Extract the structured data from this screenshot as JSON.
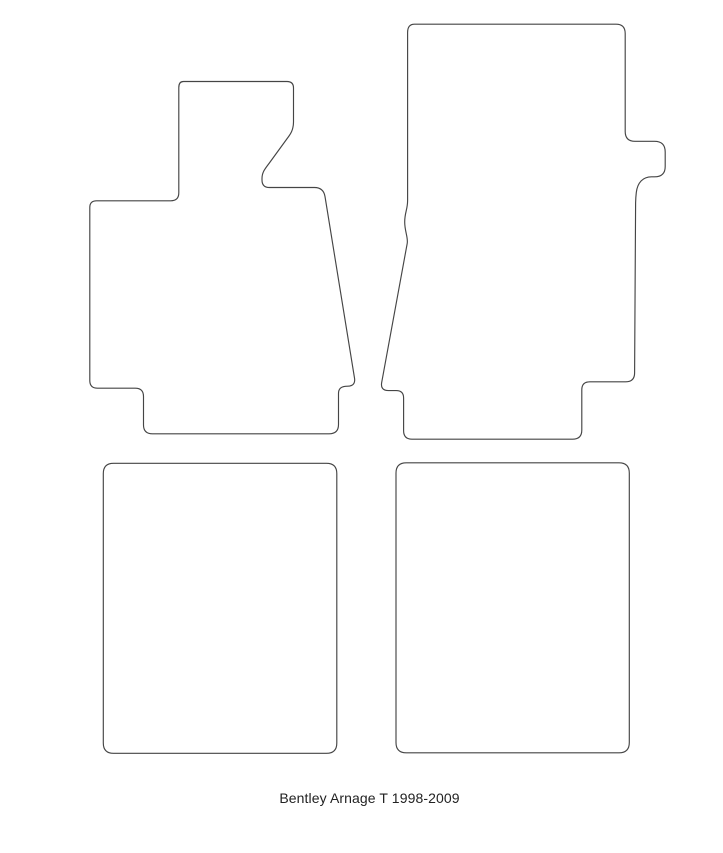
{
  "page": {
    "background_color": "#ffffff",
    "kind": "car floor mat template sheet"
  },
  "caption": {
    "text": "Bentley Arnage T 1998-2009"
  },
  "drawing": {
    "stroke_color": "#454545",
    "fill_color": "#ffffff",
    "shapes": [
      {
        "id": "front-left-mat",
        "label": "front left mat outline",
        "path": "M 183.5 81.5 H 287 Q 293.5 81.5 293.5 88 V 122 Q 293.5 130 289 136 L 269 163.5 C 264.5 169.5 262 172.5 262 178.5 V 180 Q 262 187.5 269.5 187.5 H 314.5 Q 323.5 187.5 325 196.5 L 354.5 378 Q 355.8 385.8 347.8 386.2 L 345.5 386.3 Q 338.5 386.8 338.5 393.5 V 424.5 Q 338.5 433.8 329 433.8 H 152.5 Q 143.5 433.8 143.5 425 V 396.5 Q 143.5 388.2 135.2 388.2 H 97.5 Q 89.8 388.2 89.8 380.5 V 207.5 Q 89.8 200.8 96.5 200.8 H 170.8 Q 178.8 200.8 178.8 192.8 V 87.5 Q 178.8 81.5 183.5 81.5 Z"
      },
      {
        "id": "front-right-mat",
        "label": "front right mat outline",
        "path": "M 414.5 24.2 H 616 Q 625.2 24.2 625.2 33.5 V 131.5 Q 625.2 141.3 635 141.3 H 654.5 Q 665.2 141.3 665.2 152 V 166.5 Q 665.2 176.8 654.5 176.8 H 651.5 C 643 176.8 637.5 182.5 636.3 192.5 Q 635.7 197.5 635.6 203 L 634.6 373 Q 634.5 381.8 625.7 381.8 H 589.8 Q 581.8 381.8 581.8 389.8 V 430 Q 581.8 439.2 572.5 439.2 H 412 Q 403.6 439.2 403.6 430.8 V 398 Q 403.6 390.6 396.2 390.6 H 388.5 Q 380.2 390.6 381.7 382.4 L 407.2 243.5 C 408.3 237.5 404.7 231.5 404.7 222 C 404.7 212.5 407.6 209.5 407.6 200.5 V 32.5 Q 407.6 24.2 414.5 24.2 Z"
      },
      {
        "id": "rear-left-mat",
        "label": "rear left mat outline",
        "path": "M 113.5 463.3 H 326.5 Q 336.8 463.3 336.8 473.6 V 743 Q 336.8 753.3 326.5 753.3 H 113.5 Q 103.3 753.3 103.3 743 V 473.6 Q 103.3 463.3 113.5 463.3 Z"
      },
      {
        "id": "rear-right-mat",
        "label": "rear right mat outline",
        "path": "M 406.3 462.8 H 619 Q 629.3 462.8 629.3 473.1 V 742.5 Q 629.3 752.8 619 752.8 H 406.3 Q 396 752.8 396 742.5 V 473.1 Q 396 462.8 406.3 462.8 Z"
      }
    ]
  }
}
